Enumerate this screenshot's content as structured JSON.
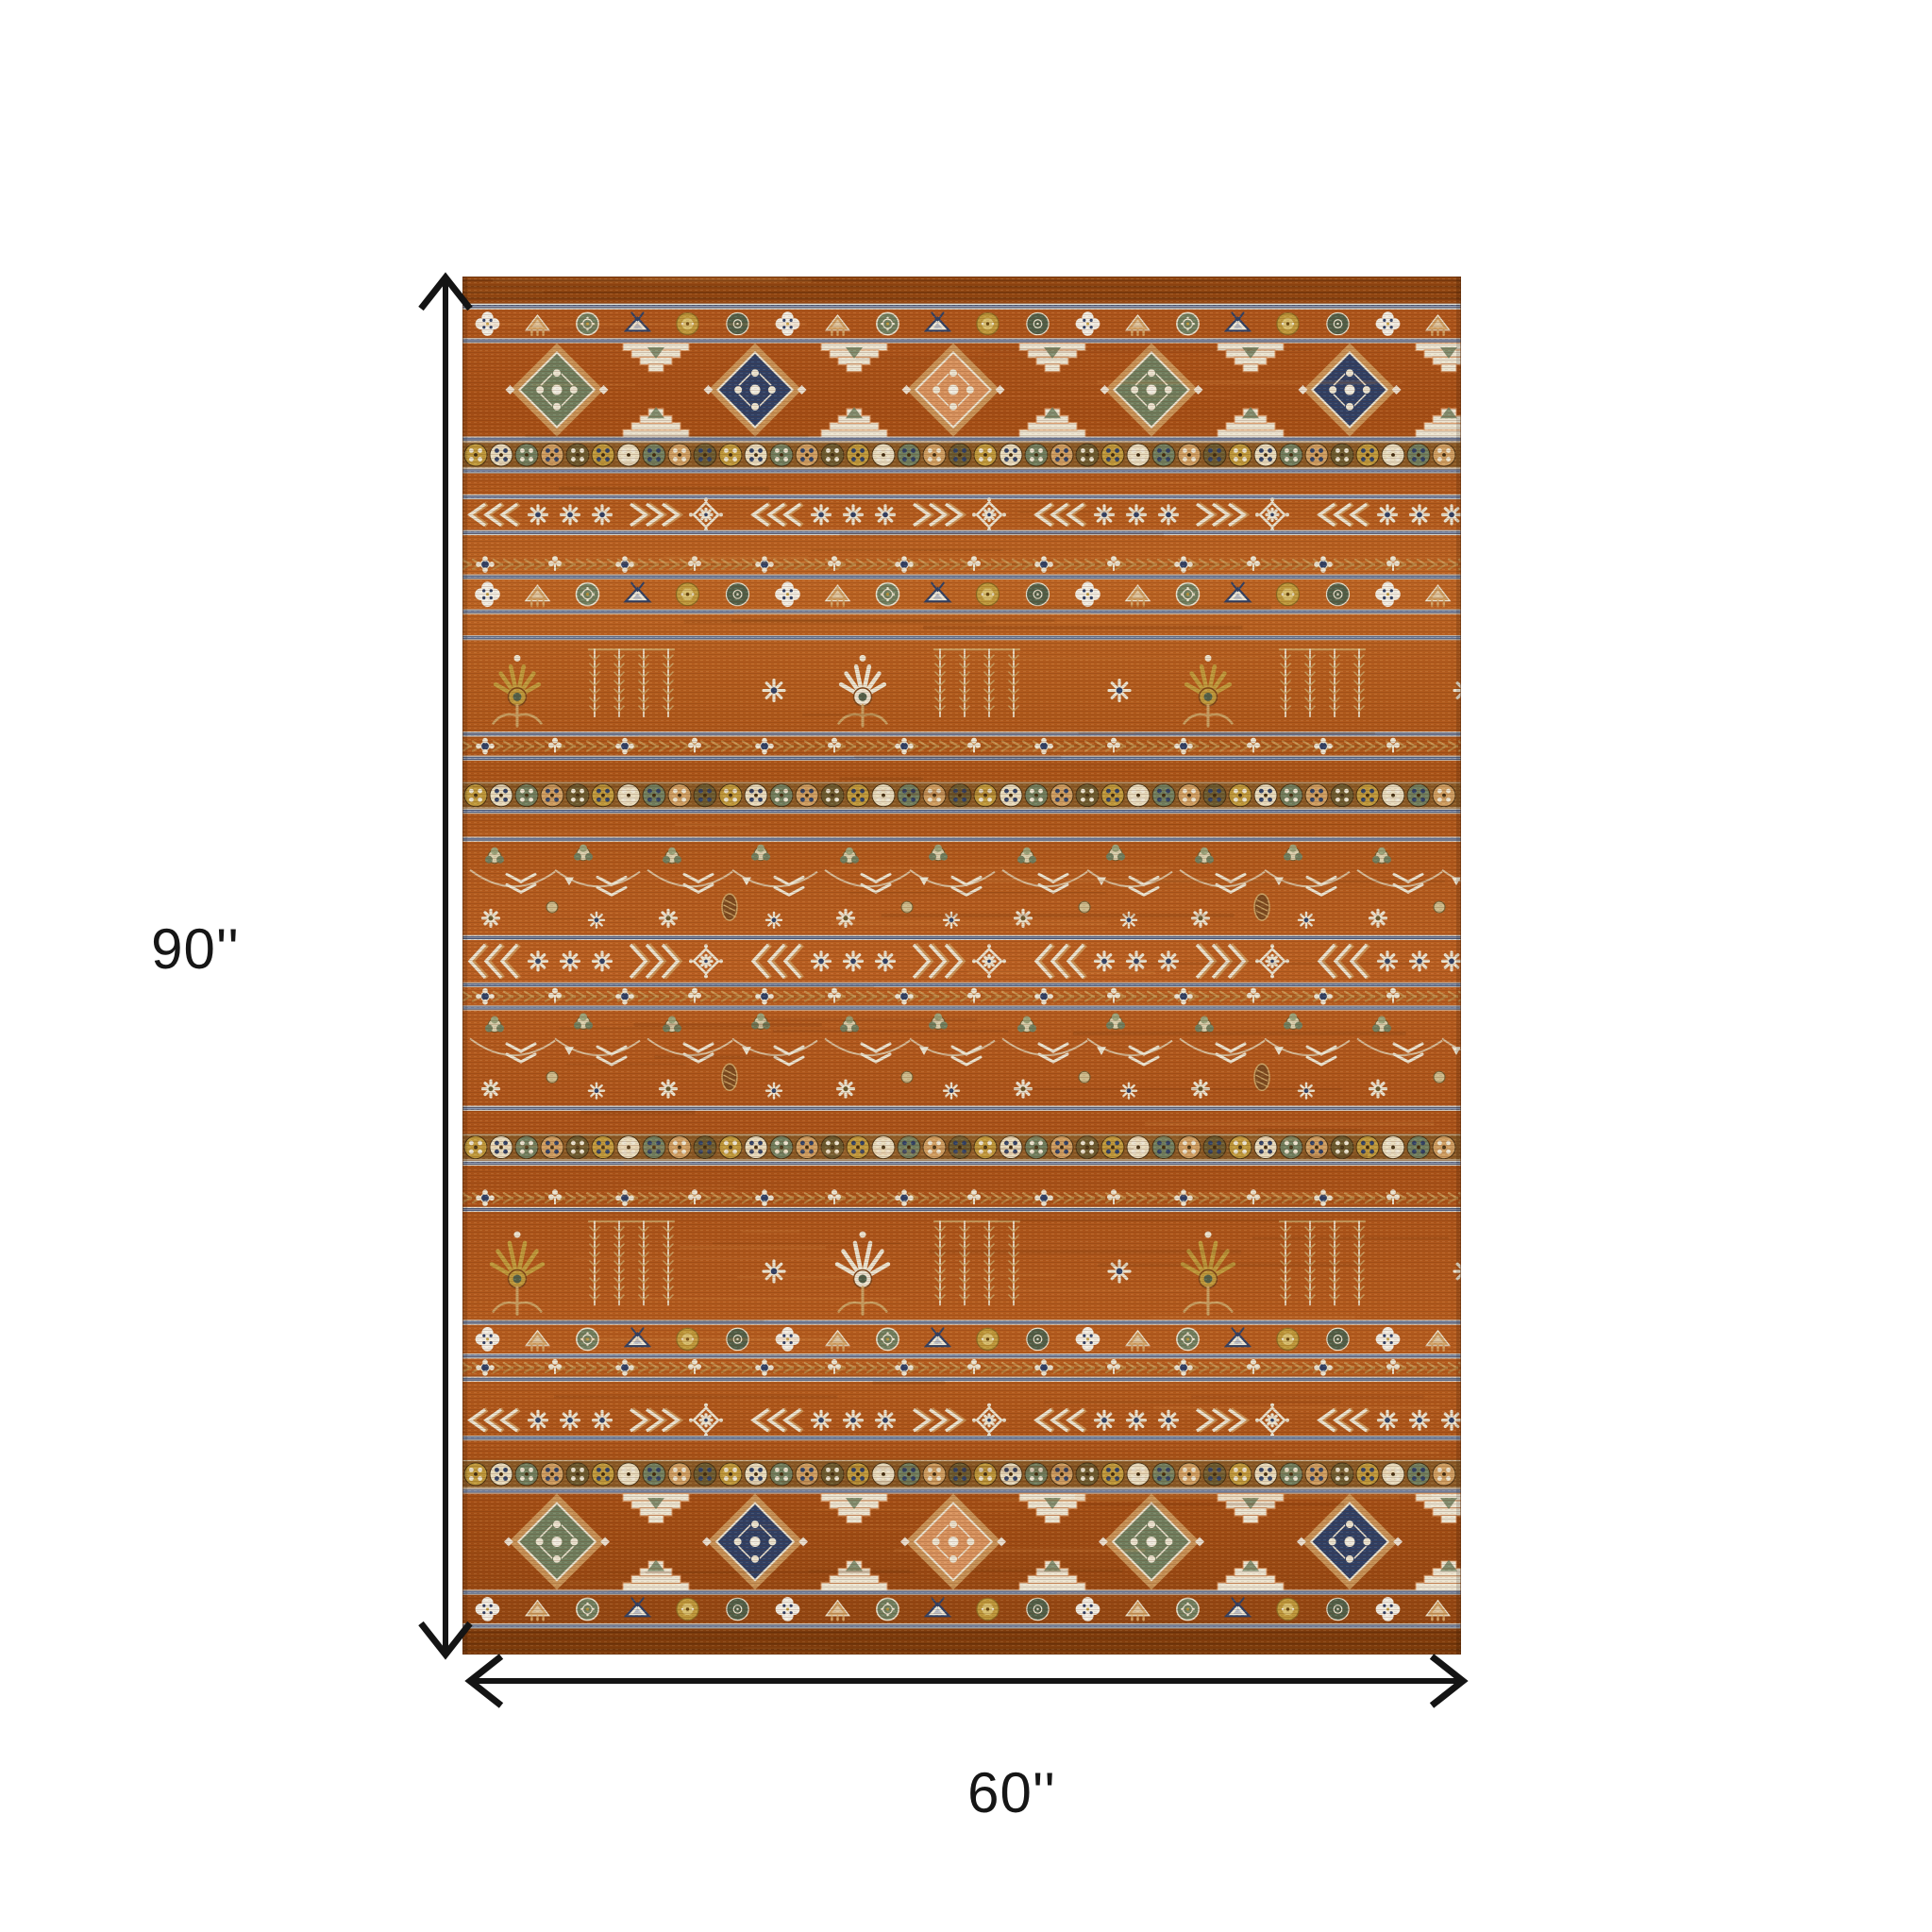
{
  "page": {
    "background": "#ffffff"
  },
  "figure": {
    "subject": "orange southwestern striped area rug, top view, with size dimension arrows"
  },
  "dimensions": {
    "height_label": "90''",
    "width_label": "60''",
    "arrow_color": "#141414",
    "label_color": "#161616"
  },
  "rug": {
    "palette": {
      "field": "#b05a1e",
      "fieldDark": "#7c3a10",
      "fieldLight": "#d08a3a",
      "cream": "#ece6d4",
      "white": "#f2efe6",
      "tan": "#cf9f63",
      "gold": "#bf9a3c",
      "teal": "#6f7f60",
      "tealDark": "#50604a",
      "navy": "#2e4066",
      "steel": "#93a0ba",
      "navyDark": "#3c4a6a",
      "salmon": "#d8935f",
      "brown": "#8a5a26",
      "stripeLight": "#e3e3dc"
    },
    "bands": [
      {
        "type": "edge",
        "h": 28
      },
      {
        "type": "stripes",
        "h": 6
      },
      {
        "type": "flowers",
        "h": 30
      },
      {
        "type": "stripes",
        "h": 5
      },
      {
        "type": "medallions",
        "h": 97
      },
      {
        "type": "stripes",
        "h": 5
      },
      {
        "type": "rosettes",
        "h": 28
      },
      {
        "type": "stripes",
        "h": 5
      },
      {
        "type": "field",
        "h": 22
      },
      {
        "type": "stripes",
        "h": 5
      },
      {
        "type": "chevrons",
        "h": 32
      },
      {
        "type": "stripes",
        "h": 5
      },
      {
        "type": "field",
        "h": 20
      },
      {
        "type": "vine",
        "h": 21
      },
      {
        "type": "stripes",
        "h": 5
      },
      {
        "type": "flowers",
        "h": 31
      },
      {
        "type": "stripes",
        "h": 5
      },
      {
        "type": "field",
        "h": 22
      },
      {
        "type": "stripes",
        "h": 5
      },
      {
        "type": "palmettes",
        "h": 95
      },
      {
        "type": "stripes",
        "h": 5
      },
      {
        "type": "vine",
        "h": 20
      },
      {
        "type": "stripes",
        "h": 5
      },
      {
        "type": "field",
        "h": 22
      },
      {
        "type": "rosettes",
        "h": 28
      },
      {
        "type": "stripes",
        "h": 5
      },
      {
        "type": "field",
        "h": 24
      },
      {
        "type": "stripes",
        "h": 5
      },
      {
        "type": "florals",
        "h": 97
      },
      {
        "type": "stripes",
        "h": 5
      },
      {
        "type": "chevrons",
        "h": 44
      },
      {
        "type": "stripes",
        "h": 5
      },
      {
        "type": "vine",
        "h": 19
      },
      {
        "type": "stripes",
        "h": 5
      },
      {
        "type": "florals",
        "h": 99
      },
      {
        "type": "stripes",
        "h": 5
      },
      {
        "type": "field",
        "h": 24
      },
      {
        "type": "rosettes",
        "h": 28
      },
      {
        "type": "stripes",
        "h": 5
      },
      {
        "type": "field",
        "h": 24
      },
      {
        "type": "vine",
        "h": 19
      },
      {
        "type": "stripes",
        "h": 5
      },
      {
        "type": "palmettes",
        "h": 112
      },
      {
        "type": "stripes",
        "h": 5
      },
      {
        "type": "flowers",
        "h": 30
      },
      {
        "type": "stripes",
        "h": 5
      },
      {
        "type": "vine",
        "h": 19
      },
      {
        "type": "stripes",
        "h": 5
      },
      {
        "type": "field",
        "h": 24
      },
      {
        "type": "chevrons",
        "h": 32
      },
      {
        "type": "stripes",
        "h": 5
      },
      {
        "type": "field",
        "h": 20
      },
      {
        "type": "rosettes",
        "h": 30
      },
      {
        "type": "stripes",
        "h": 5
      },
      {
        "type": "medallions",
        "h": 100
      },
      {
        "type": "stripes",
        "h": 5
      },
      {
        "type": "flowers",
        "h": 30
      },
      {
        "type": "stripes",
        "h": 5
      },
      {
        "type": "edge",
        "h": 27
      }
    ]
  }
}
